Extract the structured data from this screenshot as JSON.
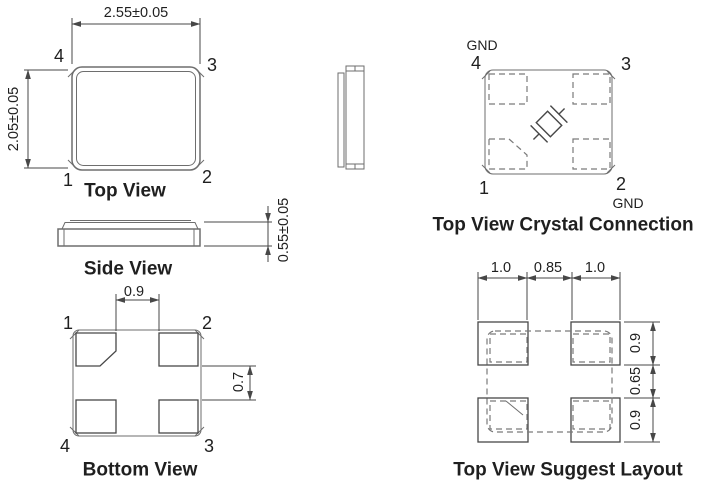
{
  "colors": {
    "bg": "#ffffff",
    "line-body": "#6e6e6e",
    "line-dim": "#474747",
    "line-dash": "#7a7a7a",
    "text": "#1f1f1f"
  },
  "views": {
    "top": {
      "title": "Top View",
      "dims": {
        "width": "2.55±0.05",
        "height": "2.05±0.05"
      },
      "pins": {
        "tl": "4",
        "tr": "3",
        "bl": "1",
        "br": "2"
      }
    },
    "side": {
      "title": "Side View",
      "dims": {
        "height": "0.55±0.05"
      }
    },
    "bottom": {
      "title": "Bottom View",
      "dims": {
        "pad_gap_x": "0.9",
        "pad_gap_y": "0.7"
      },
      "pins": {
        "tl": "1",
        "tr": "2",
        "bl": "4",
        "br": "3"
      }
    },
    "crystal": {
      "title": "Top View Crystal Connection",
      "gnd_top": "GND",
      "gnd_bottom": "GND",
      "pins": {
        "tl": "4",
        "tr": "3",
        "bl": "1",
        "br": "2"
      }
    },
    "layout": {
      "title": "Top View Suggest Layout",
      "dims": {
        "top_left": "1.0",
        "top_center": "0.85",
        "top_right": "1.0",
        "right_top": "0.9",
        "right_middle": "0.65",
        "right_bottom": "0.9"
      }
    }
  }
}
